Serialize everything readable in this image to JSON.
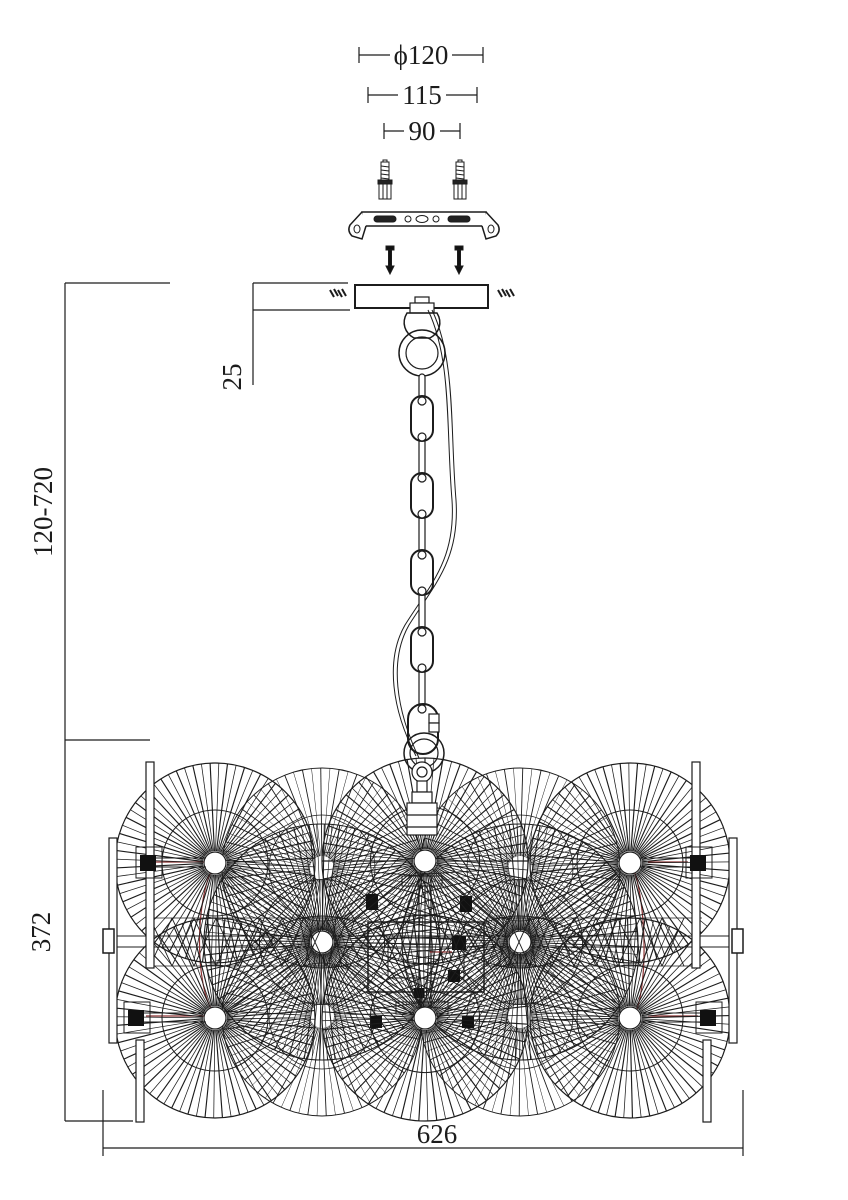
{
  "colors": {
    "line": "#1c1c1c",
    "wire": "#8b3030",
    "background": "#ffffff"
  },
  "dimensions": {
    "top": [
      {
        "name": "canopy-diameter",
        "label": "ϕ120"
      },
      {
        "name": "bracket-mounting-width",
        "label": "115"
      },
      {
        "name": "anchor-spacing",
        "label": "90"
      }
    ],
    "left": [
      {
        "name": "adjustable-suspension-height",
        "label": "120-720"
      },
      {
        "name": "body-height",
        "label": "372"
      },
      {
        "name": "canopy-thickness",
        "label": "25"
      }
    ],
    "bottom": [
      {
        "name": "body-width",
        "label": "626"
      }
    ]
  }
}
